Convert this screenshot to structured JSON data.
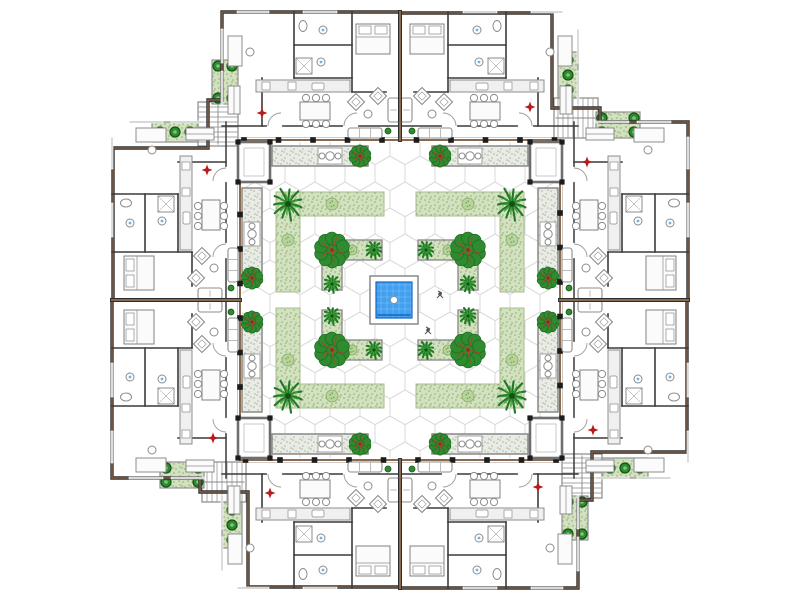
{
  "plan": {
    "canvas": {
      "w": 800,
      "h": 600
    },
    "colors": {
      "bg": "#ffffff",
      "wall_dark": "#2e2e2e",
      "wall_brown": "#8a6a4f",
      "wall_thin": "#3a3a3a",
      "gray_border": "#8f8f8f",
      "tile_line": "#d8d8d8",
      "planter_base": "#e9ece4",
      "planter_dot": "#aab4a2",
      "band_base": "#d2e1bf",
      "band_dot": "#8fae6e",
      "band_edge": "#a5bd8e",
      "tree_mid": "#2f8b2f",
      "tree_dark": "#1d6b21",
      "tree_branch": "#a34a2a",
      "palm_dark": "#1e7a24",
      "palm_light": "#3f9a37",
      "shrub_light": "#b7d49a",
      "shrub_edge": "#86a868",
      "bush_fill": "#2e8b2e",
      "bush_edge": "#145214",
      "bush_core": "#7cc47c",
      "pool_blue": "#41a0ef",
      "pool_deep": "#1565c0",
      "marker_red": "#b71c1c",
      "furn_stroke": "#8c8c8c",
      "furn_fill": "#fbfbfb",
      "stair_stroke": "#888888",
      "glass": "#9fc6e8"
    },
    "outline_quadrant": [
      [
        400,
        12
      ],
      [
        222,
        12
      ],
      [
        222,
        100
      ],
      [
        208,
        100
      ],
      [
        208,
        148
      ],
      [
        113,
        148
      ],
      [
        113,
        300
      ]
    ],
    "courtyard": {
      "tile_rect": [
        242,
        142,
        316,
        316
      ],
      "frame_line_y": 140,
      "frame_span": [
        240,
        560
      ],
      "column_start": 244,
      "column_step": 34.5,
      "column_count": 10,
      "pavilions": [
        [
          238,
          142,
          32,
          40
        ],
        [
          530,
          142,
          32,
          40
        ],
        [
          238,
          418,
          32,
          40
        ],
        [
          530,
          418,
          32,
          40
        ]
      ],
      "perimeter_arms": [
        {
          "r": [
            272,
            146,
            96,
            20
          ],
          "o": "h",
          "alcove": [
            318,
            148,
            24,
            16
          ],
          "tip_tree": [
            360,
            156
          ]
        },
        {
          "r": [
            432,
            146,
            96,
            20
          ],
          "o": "h",
          "alcove": [
            458,
            148,
            24,
            16
          ],
          "tip_tree": [
            440,
            156
          ]
        },
        {
          "r": [
            272,
            434,
            96,
            20
          ],
          "o": "h",
          "alcove": [
            318,
            436,
            24,
            16
          ],
          "tip_tree": [
            360,
            444
          ]
        },
        {
          "r": [
            432,
            434,
            96,
            20
          ],
          "o": "h",
          "alcove": [
            458,
            436,
            24,
            16
          ],
          "tip_tree": [
            440,
            444
          ]
        },
        {
          "r": [
            242,
            188,
            20,
            84
          ],
          "o": "v",
          "alcove": [
            244,
            222,
            16,
            24
          ],
          "tip_tree": [
            252,
            278
          ]
        },
        {
          "r": [
            242,
            328,
            20,
            84
          ],
          "o": "v",
          "alcove": [
            244,
            354,
            16,
            24
          ],
          "tip_tree": [
            252,
            322
          ]
        },
        {
          "r": [
            538,
            188,
            20,
            84
          ],
          "o": "v",
          "alcove": [
            540,
            222,
            16,
            24
          ],
          "tip_tree": [
            548,
            278
          ]
        },
        {
          "r": [
            538,
            328,
            20,
            84
          ],
          "o": "v",
          "alcove": [
            540,
            354,
            16,
            24
          ],
          "tip_tree": [
            548,
            322
          ]
        }
      ],
      "mid_bands": [
        [
          276,
          192,
          108,
          24
        ],
        [
          276,
          192,
          24,
          100
        ],
        [
          416,
          192,
          108,
          24
        ],
        [
          500,
          192,
          24,
          100
        ],
        [
          276,
          384,
          108,
          24
        ],
        [
          276,
          308,
          24,
          100
        ],
        [
          416,
          384,
          108,
          24
        ],
        [
          500,
          308,
          24,
          100
        ]
      ],
      "mid_palms": [
        [
          288,
          204
        ],
        [
          512,
          204
        ],
        [
          288,
          396
        ],
        [
          512,
          396
        ]
      ],
      "mid_palm_r": 17,
      "mid_shrubs": [
        [
          288,
          240
        ],
        [
          332,
          204
        ],
        [
          512,
          240
        ],
        [
          468,
          204
        ],
        [
          288,
          360
        ],
        [
          332,
          396
        ],
        [
          512,
          360
        ],
        [
          468,
          396
        ]
      ],
      "inner_arms": [
        [
          322,
          240,
          60,
          20
        ],
        [
          322,
          240,
          20,
          50
        ],
        [
          418,
          240,
          60,
          20
        ],
        [
          458,
          240,
          20,
          50
        ],
        [
          322,
          340,
          60,
          20
        ],
        [
          322,
          310,
          20,
          50
        ],
        [
          418,
          340,
          60,
          20
        ],
        [
          458,
          310,
          20,
          50
        ]
      ],
      "round_trees": [
        [
          332,
          250
        ],
        [
          468,
          250
        ],
        [
          332,
          350
        ],
        [
          468,
          350
        ]
      ],
      "round_tree_r": 16,
      "tip_palms": [
        [
          374,
          250
        ],
        [
          426,
          250
        ],
        [
          374,
          350
        ],
        [
          426,
          350
        ],
        [
          332,
          284
        ],
        [
          468,
          284
        ],
        [
          332,
          316
        ],
        [
          468,
          316
        ]
      ],
      "tip_palm_r": 9,
      "inner_shrubs": [
        [
          352,
          250
        ],
        [
          448,
          250
        ],
        [
          352,
          350
        ],
        [
          448,
          350
        ]
      ],
      "pool": {
        "deck": [
          370,
          276,
          48,
          48
        ],
        "water": [
          376,
          282,
          36,
          36
        ],
        "dot": [
          394,
          300
        ],
        "dot_r": 3.5
      },
      "people": [
        [
          428,
          330
        ],
        [
          440,
          294
        ]
      ]
    },
    "wing": {
      "rect": [
        222,
        12,
        356,
        128
      ],
      "party_wall": [
        400,
        12,
        400,
        140
      ],
      "inner_wall_y": 126,
      "walls": [
        [
          294,
          12,
          294,
          78
        ],
        [
          294,
          45,
          352,
          45
        ],
        [
          294,
          78,
          352,
          78
        ],
        [
          352,
          12,
          352,
          92
        ],
        [
          352,
          92,
          386,
          92
        ],
        [
          262,
          78,
          262,
          126
        ]
      ],
      "windows_top": [
        [
          238,
          268
        ],
        [
          304,
          336
        ]
      ],
      "windows_side": [
        [
          30,
          62
        ],
        [
          72,
          104
        ]
      ],
      "door_arcs": [
        268,
        344
      ],
      "furniture": {
        "bed": [
          356,
          24,
          34,
          30
        ],
        "desk": [
          228,
          36,
          14,
          30
        ],
        "desk_chair": [
          250,
          52
        ],
        "wardrobe": [
          228,
          86,
          12,
          28
        ],
        "toilet": [
          303,
          26
        ],
        "sinks": [
          [
            323,
            30
          ],
          [
            321,
            62
          ]
        ],
        "shower": [
          296,
          58,
          16,
          16
        ],
        "kitchen_counter": [
          256,
          80,
          94,
          12
        ],
        "kitchen_boxes": [
          [
            262,
            82,
            8,
            8
          ],
          [
            288,
            82,
            8,
            8
          ]
        ],
        "kitchen_sink": [
          312,
          83,
          12,
          7
        ],
        "dining_table": [
          300,
          102,
          30,
          18
        ],
        "dining_chairs": [
          [
            306,
            98
          ],
          [
            316,
            98
          ],
          [
            326,
            98
          ],
          [
            306,
            124
          ],
          [
            316,
            124
          ],
          [
            326,
            124
          ]
        ],
        "armchairs": [
          [
            356,
            102
          ],
          [
            378,
            96
          ]
        ],
        "side_table": [
          368,
          114
        ],
        "loveseat": [
          388,
          98,
          11,
          24
        ],
        "terrace_sofa": [
          348,
          128,
          34,
          10
        ],
        "terrace_pot": [
          388,
          131
        ]
      }
    },
    "corner": {
      "stairs": [
        198,
        102,
        40,
        44
      ],
      "strips": [
        [
          212,
          60,
          26,
          44
        ],
        [
          152,
          122,
          46,
          20
        ]
      ],
      "bushes": [
        [
          218,
          66
        ],
        [
          232,
          66
        ],
        [
          218,
          98
        ],
        [
          232,
          98
        ],
        [
          160,
          132
        ],
        [
          175,
          132
        ],
        [
          190,
          132
        ]
      ]
    },
    "marker_bases": [
      [
        262,
        113
      ],
      [
        207,
        170
      ]
    ]
  }
}
